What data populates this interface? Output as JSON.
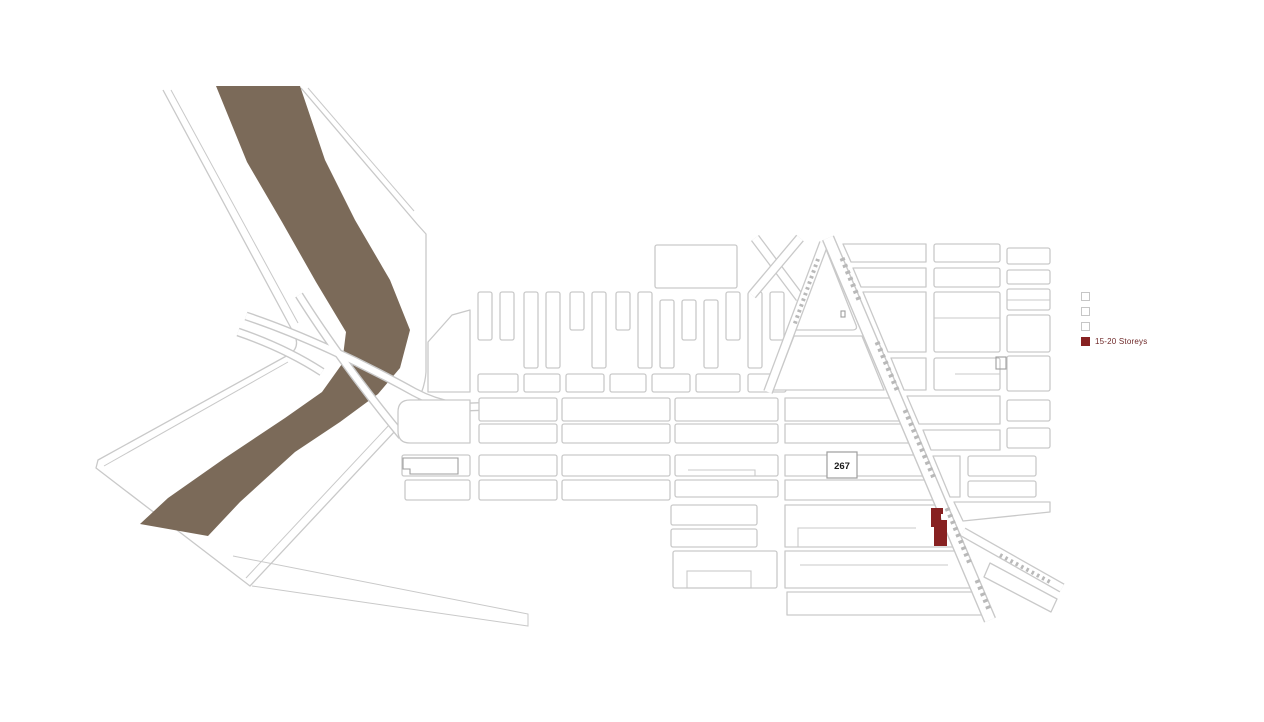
{
  "legend": {
    "items": [
      {
        "label": "",
        "filled": false
      },
      {
        "label": "",
        "filled": false
      },
      {
        "label": "",
        "filled": false
      },
      {
        "label": "15-20 Storeys",
        "filled": true
      }
    ]
  },
  "map": {
    "street_label": "267"
  },
  "icons": {
    "legend_swatch_empty": "empty-square-swatch",
    "legend_swatch_filled": "filled-square-swatch"
  },
  "colors": {
    "river": "#7b6a59",
    "building": "#872121",
    "outline": "#c9c9c9",
    "outlineStrong": "#9e9e9e",
    "hatch": "#b9b9b9",
    "legendText": "#6d2727",
    "badgeText": "#1a1a1a",
    "swatchBorder": "#c6c6c6",
    "background": "#ffffff"
  }
}
